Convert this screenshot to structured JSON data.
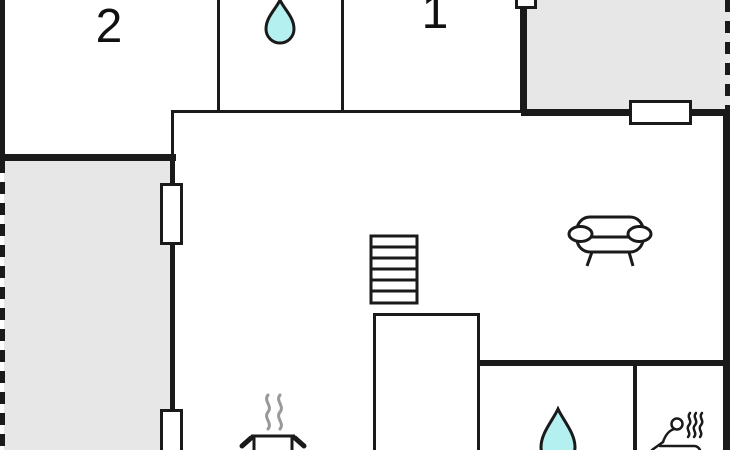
{
  "floor_plan": {
    "labels": {
      "bedroom2": "2",
      "bedroom1": "1"
    },
    "rooms": [
      {
        "id": "bedroom-2",
        "label": "2"
      },
      {
        "id": "bathroom-top",
        "icon": "water-drop"
      },
      {
        "id": "bedroom-1",
        "label": "1"
      },
      {
        "id": "living-area",
        "icon": "sofa"
      },
      {
        "id": "kitchen",
        "icon": "cooking-pot"
      },
      {
        "id": "bathroom-bottom",
        "icon": "water-drop"
      },
      {
        "id": "sauna",
        "icon": "sauna-person"
      },
      {
        "id": "terrace-left"
      },
      {
        "id": "terrace-top-right"
      }
    ],
    "features": [
      "stairs",
      "windows",
      "dashed-terrace-edges"
    ],
    "icons": [
      "water-drop-icon",
      "sofa-icon",
      "stairs-icon",
      "cooking-pot-icon",
      "sauna-person-icon"
    ],
    "colors": {
      "wall": "#1a1a1a",
      "terrace": "#e7e7e7",
      "water": "#b3f0ef",
      "steam": "#999999",
      "background": "#ffffff"
    }
  }
}
